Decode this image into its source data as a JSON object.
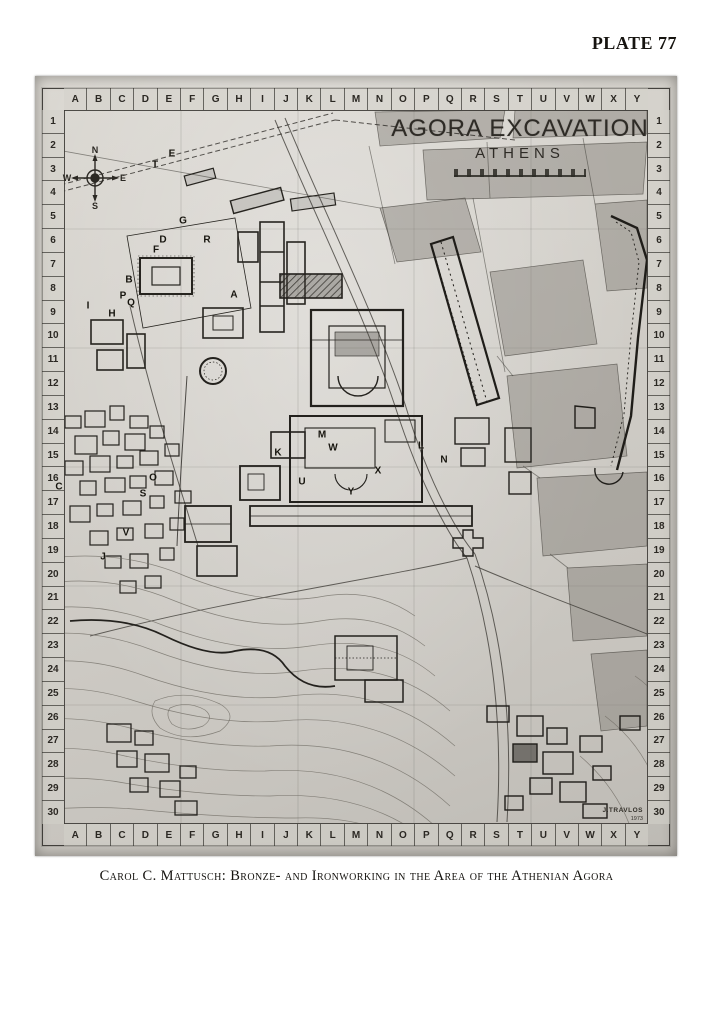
{
  "page": {
    "plate_label": "PLATE 77",
    "caption": "Carol C. Mattusch: Bronze- and Ironworking in the Area of the Athenian Agora"
  },
  "map": {
    "title": "AGORA EXCAVATION",
    "subtitle": "ATHENS",
    "signature": "J.TRAVLOS",
    "signature_year": "1973",
    "compass": {
      "n": "N",
      "e": "E",
      "s": "S",
      "w": "W"
    },
    "grid": {
      "columns": [
        "A",
        "B",
        "C",
        "D",
        "E",
        "F",
        "G",
        "H",
        "I",
        "J",
        "K",
        "L",
        "M",
        "N",
        "O",
        "P",
        "Q",
        "R",
        "S",
        "T",
        "U",
        "V",
        "W",
        "X",
        "Y"
      ],
      "rows": [
        "1",
        "2",
        "3",
        "4",
        "5",
        "6",
        "7",
        "8",
        "9",
        "10",
        "11",
        "12",
        "13",
        "14",
        "15",
        "16",
        "17",
        "18",
        "19",
        "20",
        "21",
        "22",
        "23",
        "24",
        "25",
        "26",
        "27",
        "28",
        "29",
        "30"
      ]
    },
    "site_labels": [
      {
        "label": "A",
        "x": 199,
        "y": 219
      },
      {
        "label": "B",
        "x": 94,
        "y": 204
      },
      {
        "label": "C",
        "x": 24,
        "y": 411
      },
      {
        "label": "D",
        "x": 128,
        "y": 164
      },
      {
        "label": "E",
        "x": 137,
        "y": 78
      },
      {
        "label": "F",
        "x": 121,
        "y": 174
      },
      {
        "label": "G",
        "x": 148,
        "y": 145
      },
      {
        "label": "H",
        "x": 77,
        "y": 238
      },
      {
        "label": "I",
        "x": 53,
        "y": 230
      },
      {
        "label": "J",
        "x": 68,
        "y": 481
      },
      {
        "label": "K",
        "x": 243,
        "y": 377
      },
      {
        "label": "L",
        "x": 386,
        "y": 370
      },
      {
        "label": "M",
        "x": 287,
        "y": 359
      },
      {
        "label": "N",
        "x": 409,
        "y": 384
      },
      {
        "label": "O",
        "x": 118,
        "y": 402
      },
      {
        "label": "P",
        "x": 88,
        "y": 220
      },
      {
        "label": "Q",
        "x": 96,
        "y": 227
      },
      {
        "label": "R",
        "x": 172,
        "y": 164
      },
      {
        "label": "S",
        "x": 108,
        "y": 418
      },
      {
        "label": "T",
        "x": 120,
        "y": 89
      },
      {
        "label": "U",
        "x": 267,
        "y": 406
      },
      {
        "label": "V",
        "x": 91,
        "y": 457
      },
      {
        "label": "W",
        "x": 298,
        "y": 372
      },
      {
        "label": "X",
        "x": 343,
        "y": 395
      },
      {
        "label": "Y",
        "x": 316,
        "y": 416
      }
    ],
    "colors": {
      "photo_bg": "#d2cfc9",
      "ink": "#23211d",
      "block_gray": "#8f8c85"
    }
  }
}
